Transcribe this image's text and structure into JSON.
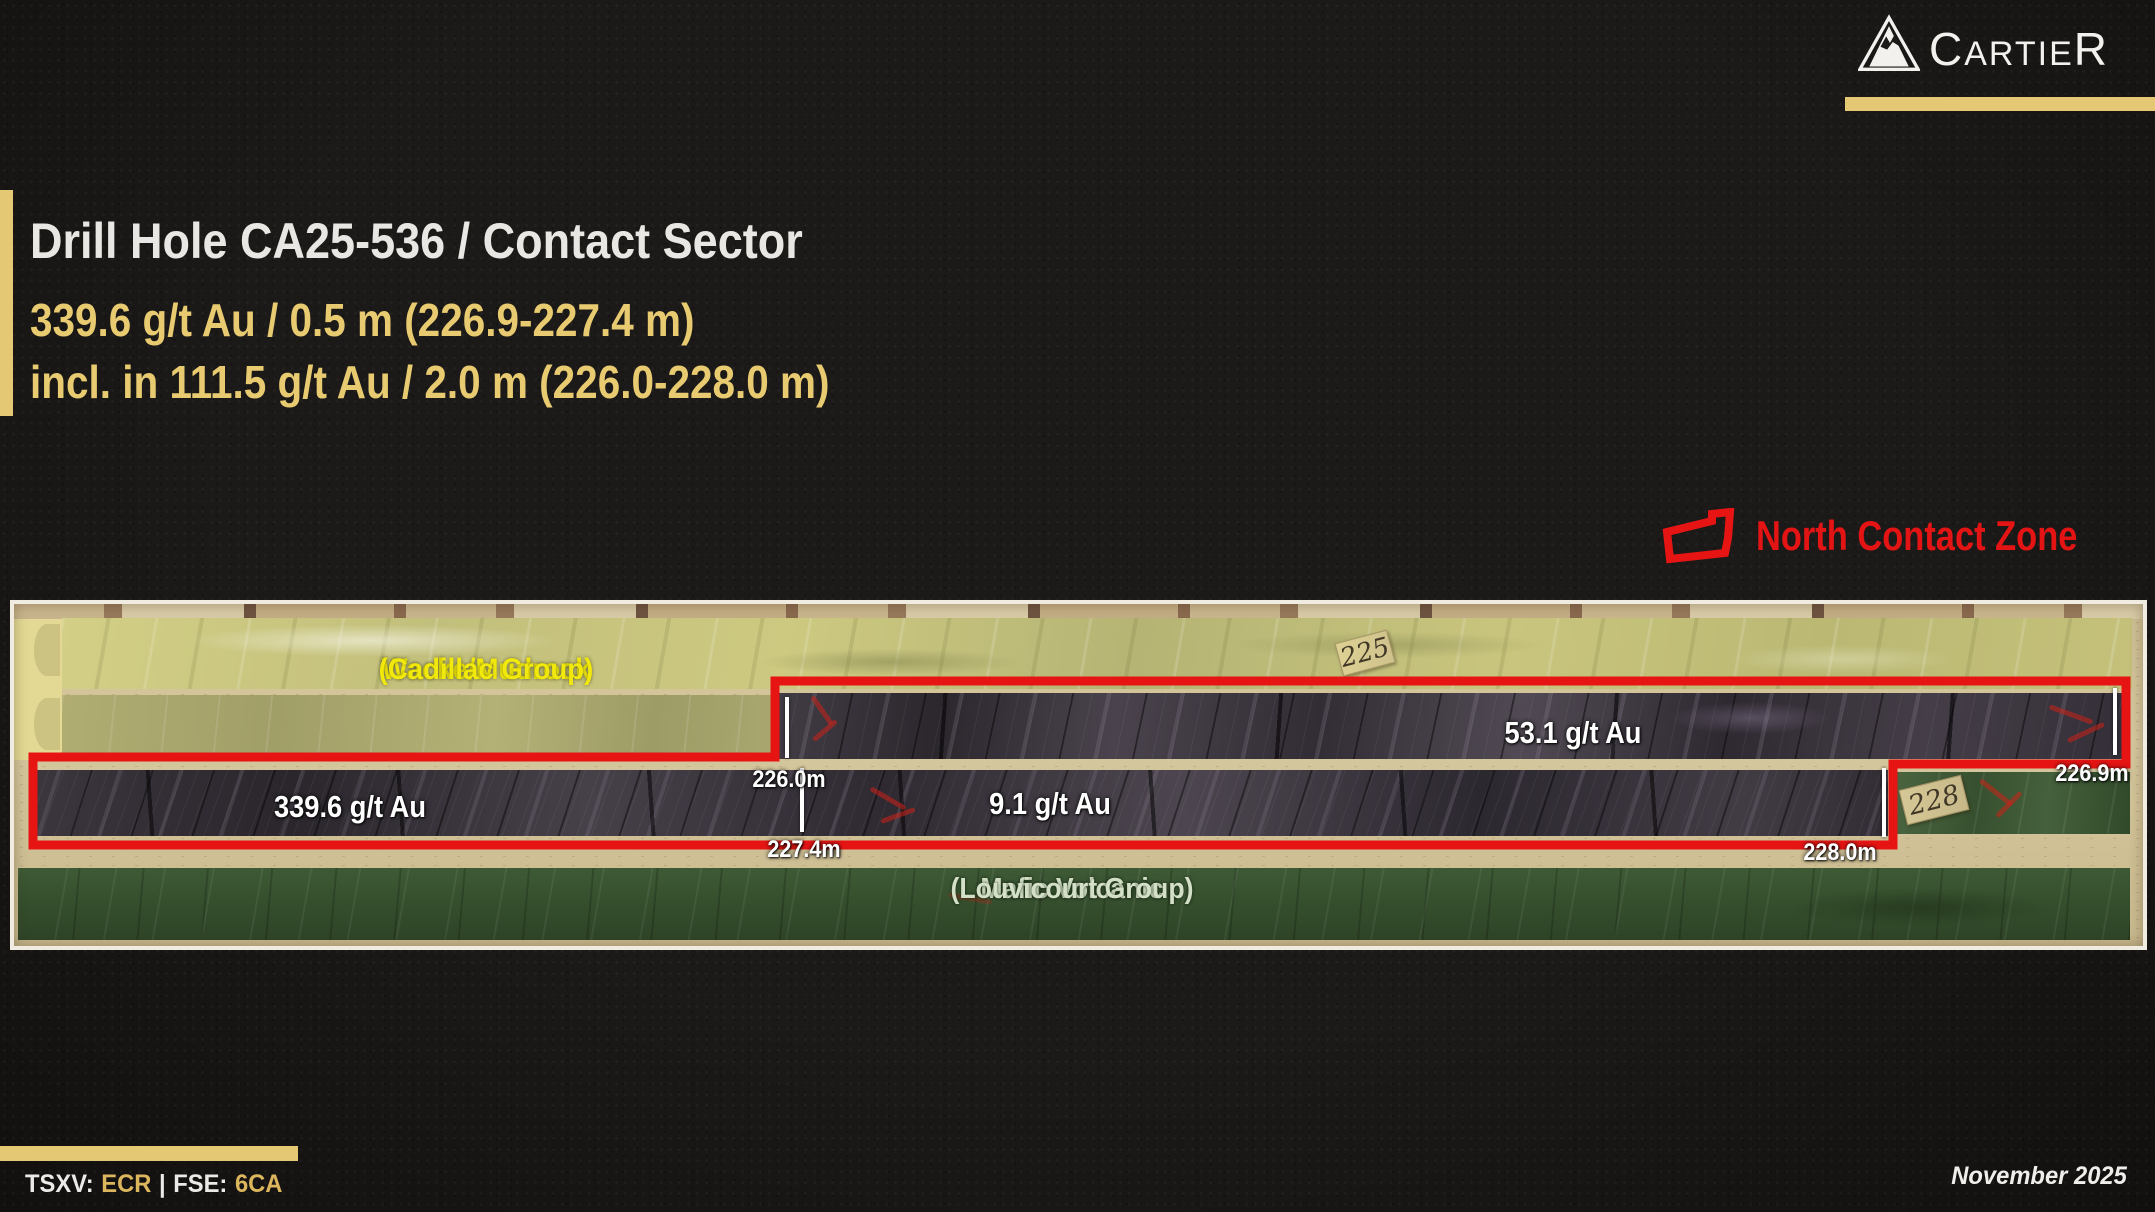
{
  "slide": {
    "logo": {
      "prefix": "C",
      "middle": "ARTIE",
      "suffix": "R"
    },
    "header": {
      "title": "Drill Hole CA25-536 / Contact Sector",
      "intercept_main": "339.6 g/t Au / 0.5 m (226.9-227.4 m)",
      "intercept_incl": "incl. in 111.5 g/t Au / 2.0 m (226.0-228.0 m)"
    },
    "legend": {
      "label": "North Contact Zone"
    },
    "core_photo": {
      "lithology_top": {
        "line1": "Wacke/Mudrock",
        "line2": "(Cadillac Group)"
      },
      "lithology_bottom": {
        "line1": "Mafic Volcanic",
        "line2": "(Louvicourt Group)"
      },
      "assays": {
        "row1": "53.1 g/t Au",
        "row2_left": "339.6 g/t Au",
        "row2_right": "9.1 g/t Au"
      },
      "depths": {
        "d226_0": "226.0m",
        "d226_9": "226.9m",
        "d227_4": "227.4m",
        "d228_0": "228.0m"
      },
      "blocks": {
        "b225": "225",
        "b228": "228"
      }
    },
    "footer": {
      "tsxv_label": "TSXV:",
      "tsxv_value": "ECR",
      "divider": "|",
      "fse_label": "FSE:",
      "fse_value": "6CA",
      "date": "November 2025"
    },
    "colors": {
      "accent_gold": "#e5c873",
      "zone_red": "#e71414",
      "lith_yellow": "#f2e90c",
      "lith_pale_green": "#d3dfc6",
      "background": "#1c1a18"
    }
  }
}
